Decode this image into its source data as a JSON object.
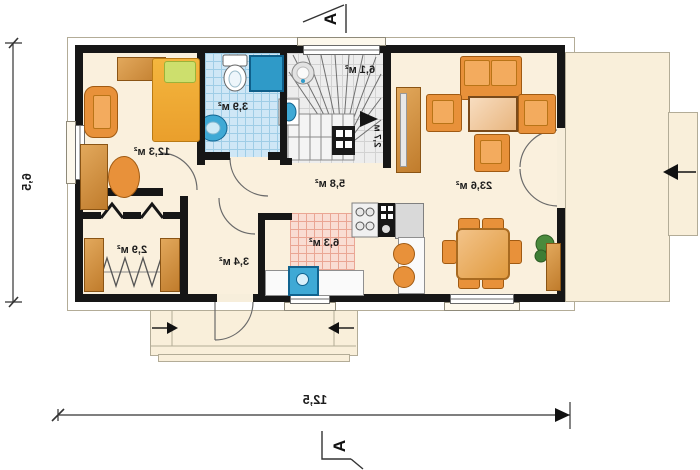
{
  "plan_type": "house ground floor plan (mirrored print)",
  "section": {
    "top_marker": "A",
    "bottom_marker": "A"
  },
  "dimensions": {
    "overall_width": "12,5",
    "overall_height": "6,5"
  },
  "rooms": {
    "bedroom": {
      "area": "12,3 м²"
    },
    "bathroom": {
      "area": "3,9 м²"
    },
    "stair_hall": {
      "area": "6,1 м²",
      "stair_width": "2,7 м"
    },
    "hall": {
      "area": "5,8 м²"
    },
    "wardrobe": {
      "area": "2,9 м²"
    },
    "entry_corridor": {
      "area": "3,4 м²"
    },
    "kitchen": {
      "area": "6,3 м²"
    },
    "living_room": {
      "area": "23,6 м²"
    }
  },
  "colors": {
    "wall": "#161616",
    "floor": "#faf0dd",
    "furniture_orange": "#e8913a",
    "water_fixture_blue": "#3fa9d5",
    "bathroom_tile": "#cfe7f6",
    "kitchen_tile": "#f9ddd3",
    "stair_tile": "#ededed"
  }
}
